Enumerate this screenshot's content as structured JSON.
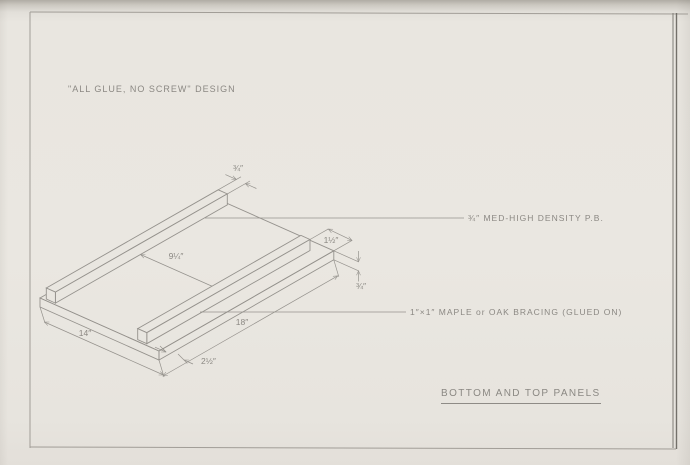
{
  "note": "\"ALL GLUE, NO SCREW\" DESIGN",
  "title": "BOTTOM AND TOP PANELS",
  "callouts": {
    "panel": "¾″ MED-HIGH DENSITY  P.B.",
    "bracing": "1″×1″ MAPLE or OAK BRACING (GLUED ON)"
  },
  "dims": {
    "brace_width": "¾″",
    "brace_spacing": "9¼″",
    "end_inset": "1½″",
    "thickness": "¾″",
    "length": "18″",
    "depth": "14″",
    "front_offset": "2½″"
  },
  "colors": {
    "paper": "#e9e6e0",
    "pencil": "#8e8b86"
  }
}
